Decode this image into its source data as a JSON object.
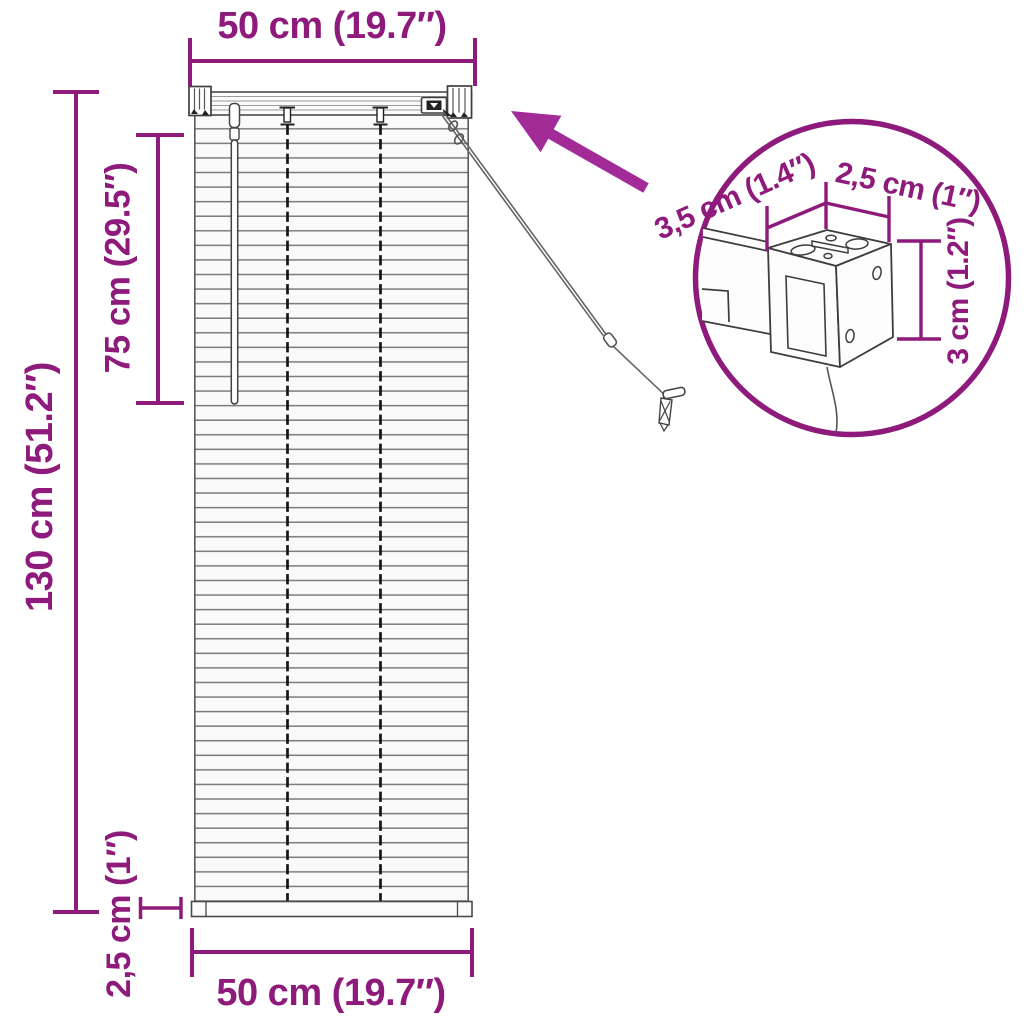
{
  "colors": {
    "dimension_magenta": "#8E1A7B",
    "arrow_magenta": "#A32B98",
    "drawing_gray": "#4a4a4a"
  },
  "dimensions": {
    "top_width": "50 cm (19.7″)",
    "total_height": "130 cm (51.2″)",
    "upper_height": "75 cm (29.5″)",
    "bottom_rail_thickness": "2,5 cm (1″)",
    "bottom_width": "50 cm (19.7″)",
    "detail_depth": "3,5 cm (1.4″)",
    "detail_width": "2,5 cm (1″)",
    "detail_height": "3 cm (1.2″)"
  }
}
